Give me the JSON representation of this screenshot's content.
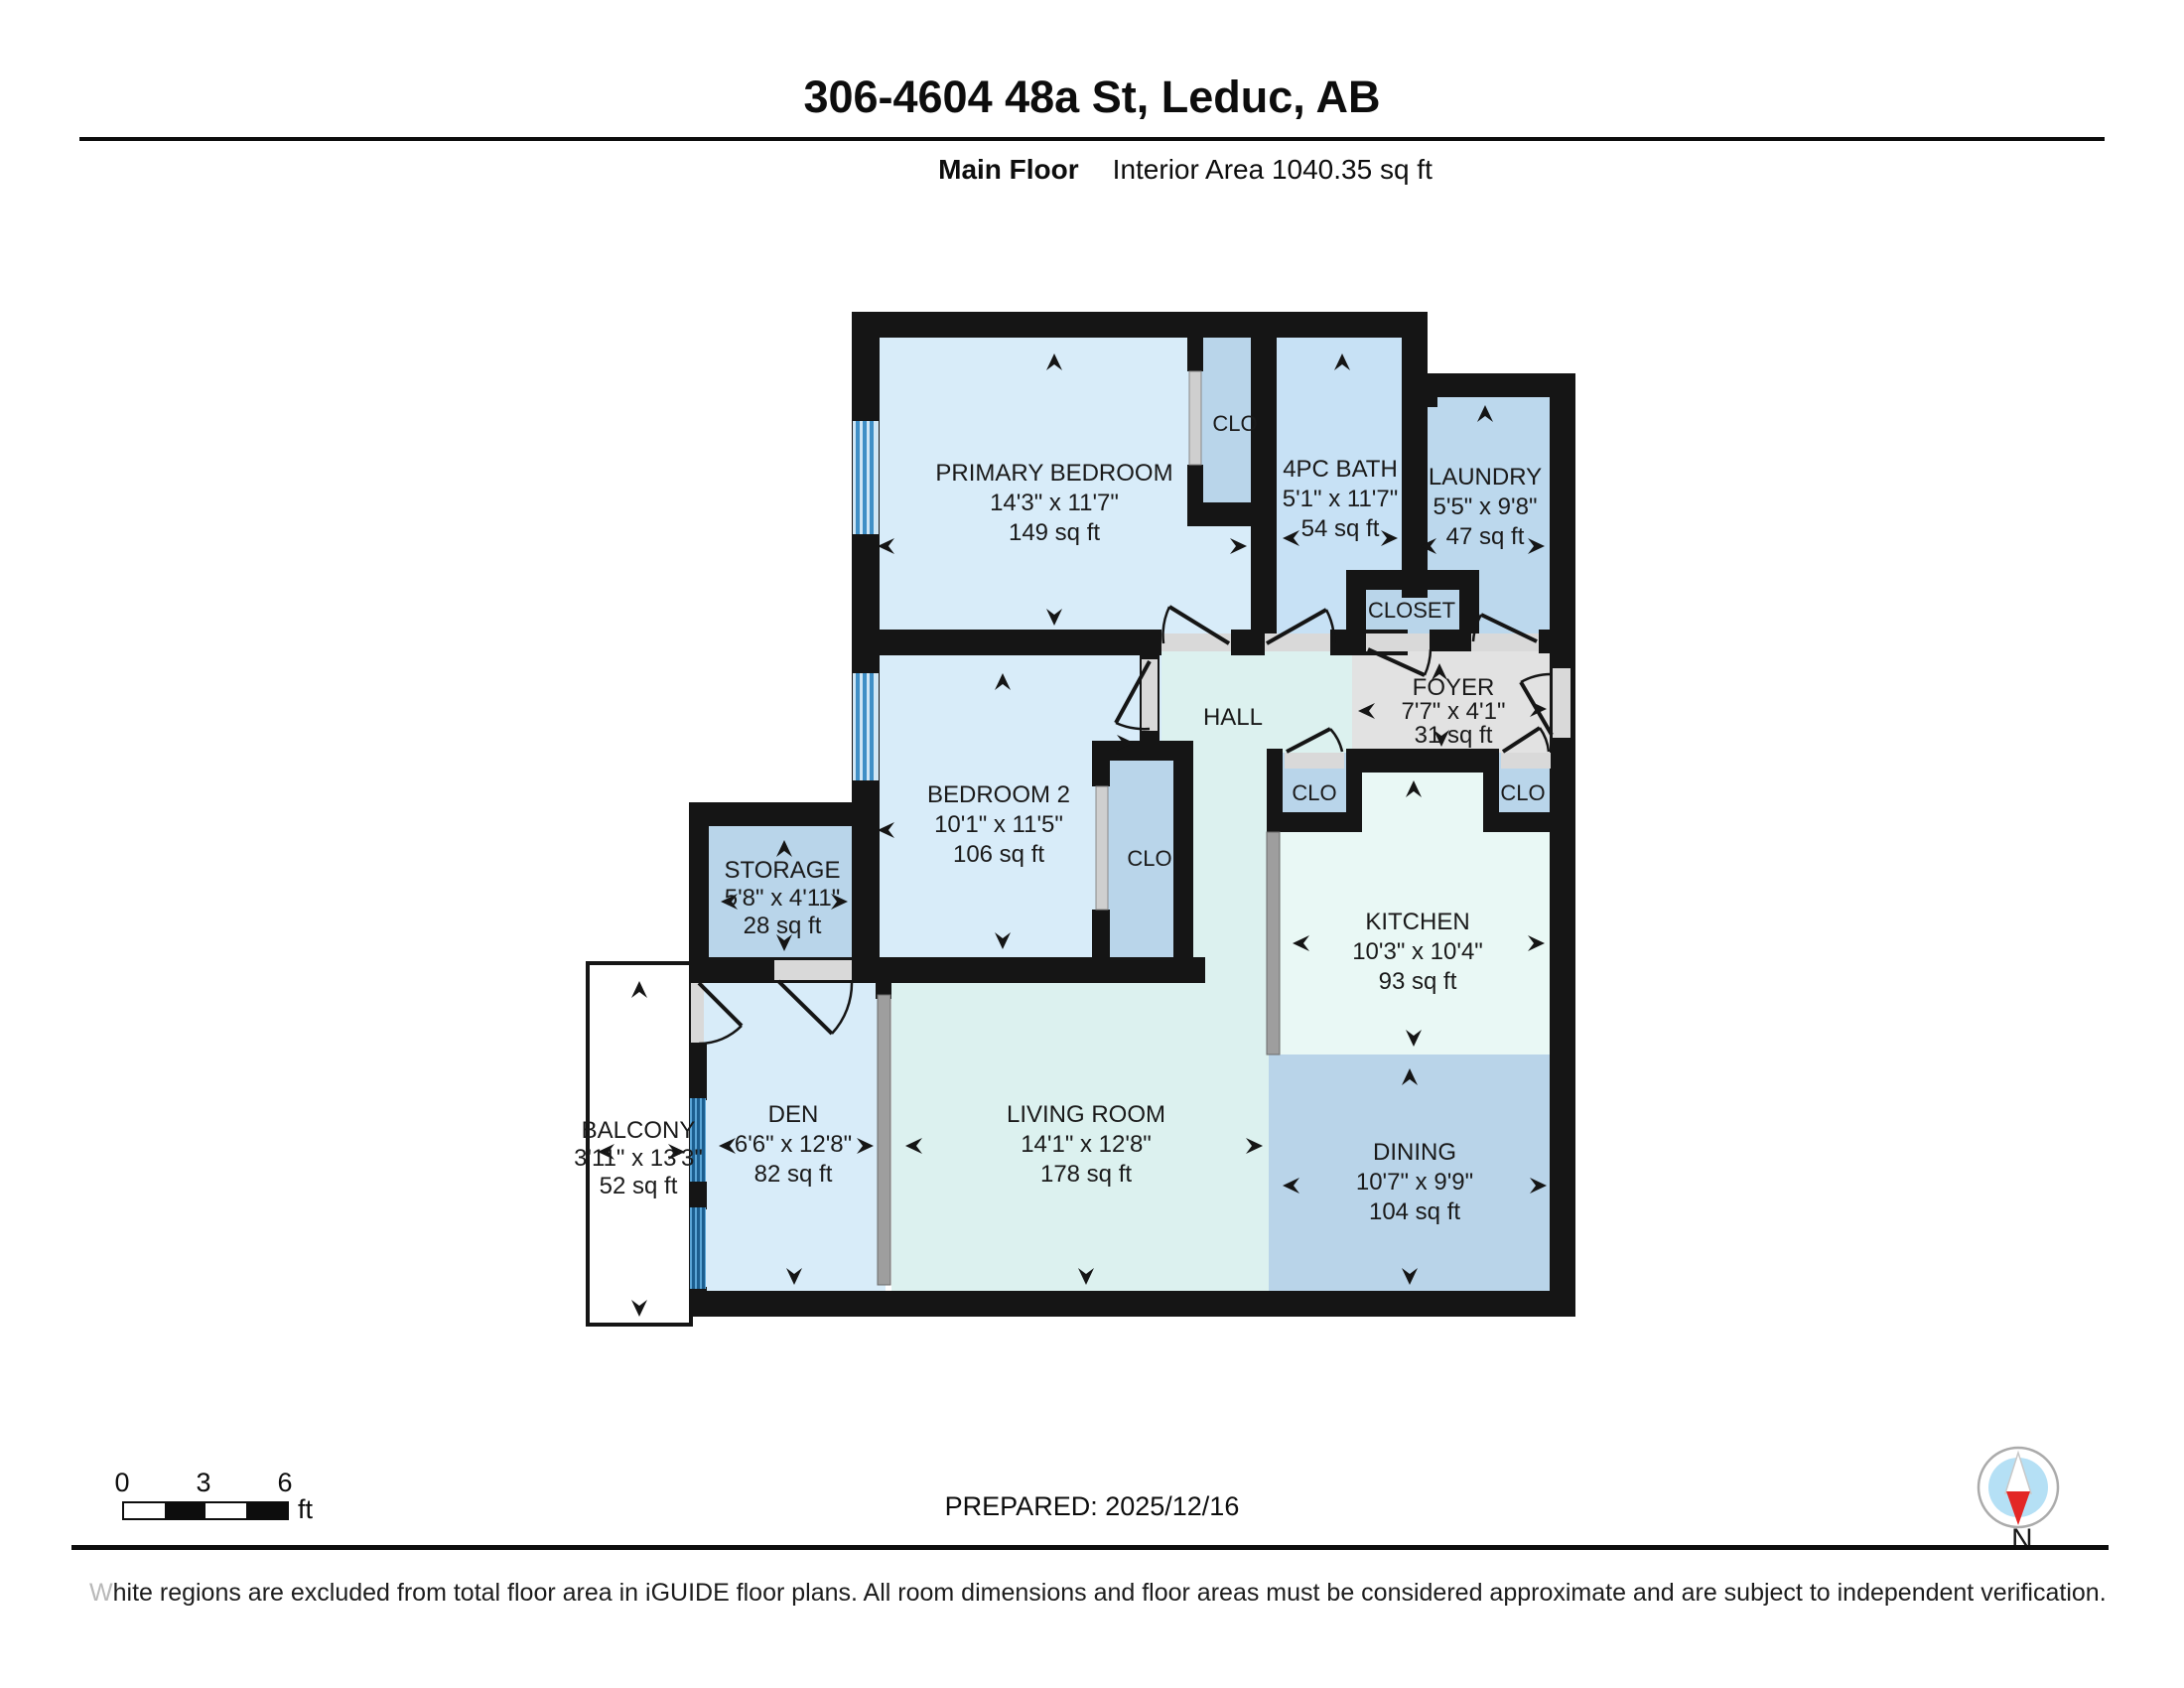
{
  "header": {
    "title": "306-4604 48a St, Leduc, AB",
    "floor_label": "Main Floor",
    "area_label": "Interior Area 1040.35 sq ft"
  },
  "rooms": {
    "primary": {
      "name": "PRIMARY BEDROOM",
      "dims": "14'3\" x 11'7\"",
      "area": "149 sq ft"
    },
    "clo_primary": {
      "name": "CLO"
    },
    "bath": {
      "name": "4PC BATH",
      "dims": "5'1\" x 11'7\"",
      "area": "54 sq ft"
    },
    "laundry": {
      "name": "LAUNDRY",
      "dims": "5'5\" x 9'8\"",
      "area": "47 sq ft"
    },
    "closet": {
      "name": "CLOSET"
    },
    "foyer": {
      "name": "FOYER",
      "dims": "7'7\" x 4'1\"",
      "area": "31 sq ft"
    },
    "hall": {
      "name": "HALL"
    },
    "bedroom2": {
      "name": "BEDROOM 2",
      "dims": "10'1\" x 11'5\"",
      "area": "106 sq ft"
    },
    "clo_bedroom2": {
      "name": "CLO"
    },
    "storage": {
      "name": "STORAGE",
      "dims": "5'8\" x 4'11\"",
      "area": "28 sq ft"
    },
    "clo_kitchen_left": {
      "name": "CLO"
    },
    "clo_kitchen_right": {
      "name": "CLO"
    },
    "kitchen": {
      "name": "KITCHEN",
      "dims": "10'3\" x 10'4\"",
      "area": "93 sq ft"
    },
    "balcony": {
      "name": "BALCONY",
      "dims": "3'11\" x 13'3\"",
      "area": "52 sq ft"
    },
    "den": {
      "name": "DEN",
      "dims": "6'6\" x 12'8\"",
      "area": "82 sq ft"
    },
    "living": {
      "name": "LIVING ROOM",
      "dims": "14'1\" x 12'8\"",
      "area": "178 sq ft"
    },
    "dining": {
      "name": "DINING",
      "dims": "10'7\" x 9'9\"",
      "area": "104 sq ft"
    }
  },
  "scale_bar": {
    "ticks": [
      "0",
      "3",
      "6"
    ],
    "unit": "ft"
  },
  "prepared_label": "PREPARED: 2025/12/16",
  "compass": {
    "label": "N"
  },
  "footer": {
    "disclaimer_lead": "W",
    "disclaimer_rest": "hite regions are excluded from total floor area in iGUIDE floor plans. All room dimensions and floor areas must be considered approximate and are subject to independent verification."
  },
  "colors": {
    "wall": "#151515",
    "bedroom_fill": "#d8ecf9",
    "closet_fill": "#b9d5ea",
    "bath_fill": "#c7e1f5",
    "laundry_fill": "#bcd8ed",
    "dining_fill": "#b9d4e9",
    "living_fill": "#dcf1ef",
    "kitchen_fill": "#e9f8f5",
    "foyer_fill": "#e2e2e2",
    "window_blue": "#3f8fc6",
    "compass_red": "#e32726"
  }
}
